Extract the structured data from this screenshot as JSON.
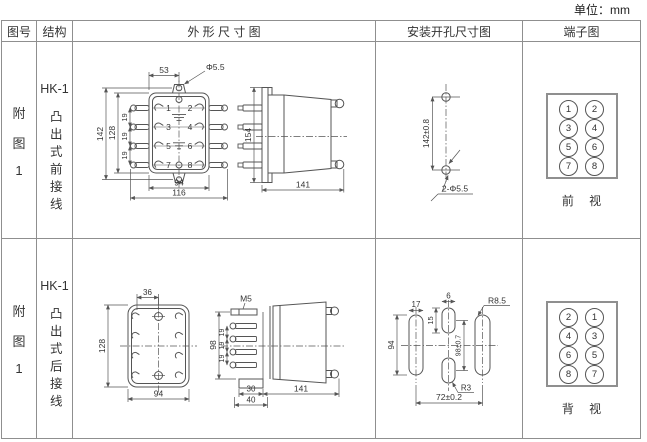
{
  "unit_label": "单位：mm",
  "table": {
    "headers": {
      "fig_no": "图号",
      "structure": "结构",
      "outline": "外 形 尺 寸 图",
      "mounting": "安装开孔尺寸图",
      "terminal": "端子图"
    },
    "rows": [
      {
        "fig_no": [
          "附",
          "图",
          "1"
        ],
        "model": "HK-1",
        "structure_desc": "凸出式前接线",
        "outline_dims": {
          "top_offset": "53",
          "ear_hole": "Φ5.5",
          "height_outer": "142",
          "height_inner": "128",
          "pitch1": "19",
          "pitch2": "19",
          "pitch3": "19",
          "width_inner": "94",
          "width_outer": "116",
          "side_height": "154",
          "side_depth": "141"
        },
        "mounting_dims": {
          "hole_spacing": "142±0.8",
          "holes": "2-Φ5.5"
        },
        "terminals": {
          "order": [
            "1",
            "2",
            "3",
            "4",
            "5",
            "6",
            "7",
            "8"
          ],
          "view_label": "前 视"
        }
      },
      {
        "fig_no": [
          "附",
          "图",
          "1"
        ],
        "model": "HK-1",
        "structure_desc": "凸出式后接线",
        "outline_dims": {
          "top_offset": "36",
          "height": "128",
          "width": "94",
          "screw": "M5",
          "stud_span": "98",
          "pitch1": "19",
          "pitch2": "19",
          "pitch3": "19",
          "base_depth": "30",
          "base_width": "40",
          "side_depth": "141"
        },
        "mounting_dims": {
          "slot_width": "17",
          "slot_height": "94",
          "mid_width": "6",
          "mid_height": "15",
          "v_spacing": "98±0.7",
          "radius_big": "R8.5",
          "radius_small": "R3",
          "h_spacing": "72±0.2"
        },
        "terminals": {
          "order": [
            "2",
            "1",
            "4",
            "3",
            "6",
            "5",
            "8",
            "7"
          ],
          "view_label": "背 视"
        }
      }
    ]
  }
}
